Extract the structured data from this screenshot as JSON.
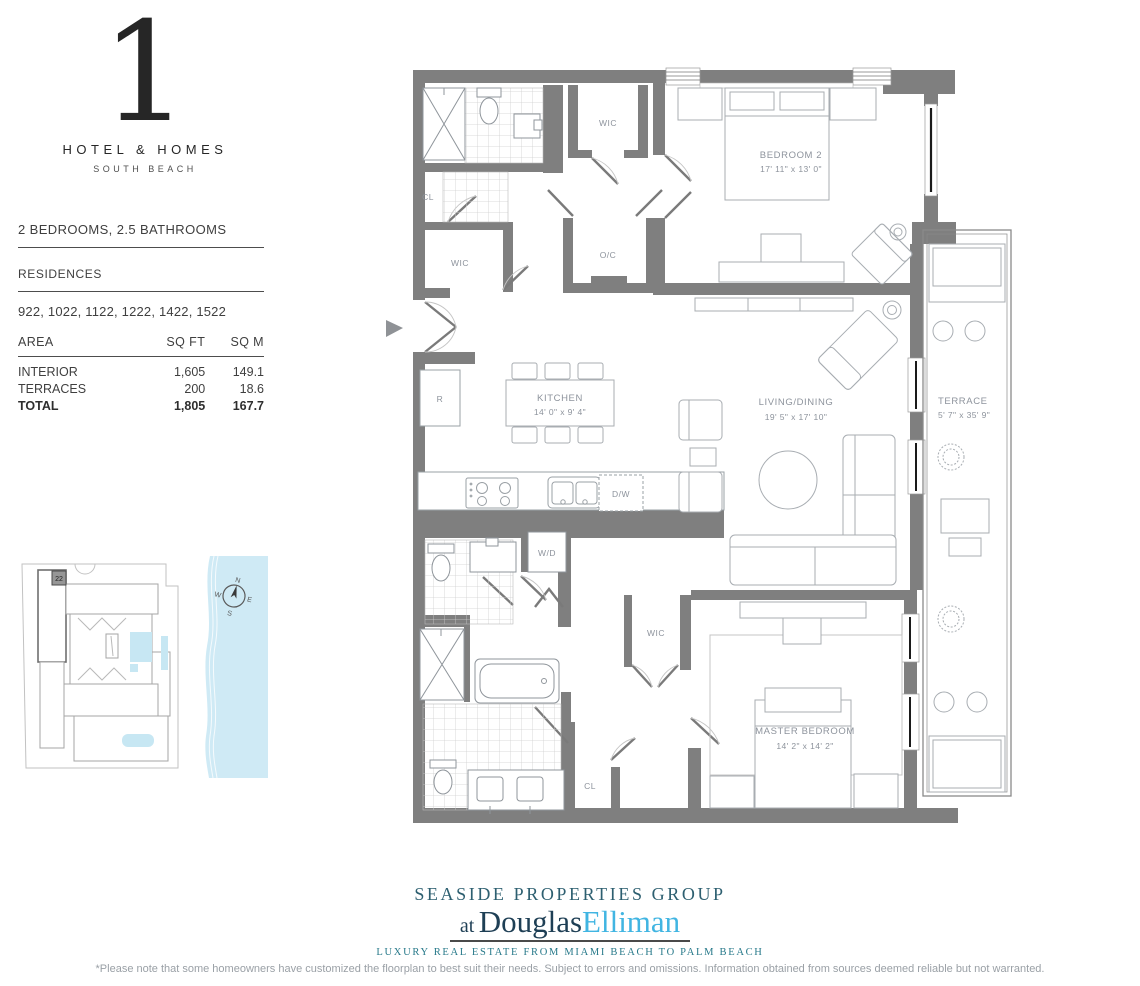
{
  "logo": {
    "numeral": "1",
    "brand": "HOTEL & HOMES",
    "location": "SOUTH BEACH"
  },
  "unit": {
    "headline": "2 BEDROOMS, 2.5 BATHROOMS",
    "residences_label": "RESIDENCES",
    "residences": "922, 1022, 1122, 1222, 1422, 1522"
  },
  "area_table": {
    "headers": {
      "area": "AREA",
      "sqft": "SQ FT",
      "sqm": "SQ M"
    },
    "rows": [
      {
        "label": "INTERIOR",
        "sqft": "1,605",
        "sqm": "149.1"
      },
      {
        "label": "TERRACES",
        "sqft": "200",
        "sqm": "18.6"
      },
      {
        "label": "TOTAL",
        "sqft": "1,805",
        "sqm": "167.7"
      }
    ]
  },
  "floorplan": {
    "rooms": {
      "bedroom2": {
        "name": "BEDROOM 2",
        "dims": "17' 11\" x 13' 0\""
      },
      "kitchen": {
        "name": "KITCHEN",
        "dims": "14' 0\" x 9' 4\""
      },
      "living": {
        "name": "LIVING/DINING",
        "dims": "19' 5\" x 17' 10\""
      },
      "master": {
        "name": "MASTER BEDROOM",
        "dims": "14' 2\" x 14' 2\""
      },
      "terrace": {
        "name": "TERRACE",
        "dims": "5' 7\" x 35' 9\""
      }
    },
    "small_labels": {
      "wic": "WIC",
      "oc": "O/C",
      "cl": "CL",
      "r": "R",
      "dw": "D/W",
      "wd": "W/D"
    }
  },
  "siteplan": {
    "unit_marker": "22",
    "compass": {
      "n": "N",
      "e": "E",
      "s": "S",
      "w": "W"
    }
  },
  "footer": {
    "group": "SEASIDE PROPERTIES GROUP",
    "at": "at",
    "brand_first": "Douglas",
    "brand_second": "Elliman",
    "tagline": "LUXURY REAL ESTATE FROM MIAMI BEACH TO PALM BEACH",
    "disclaimer": "*Please note that some homeowners have customized the floorplan to best suit their needs. Subject to errors and omissions. Information obtained from sources deemed reliable but not warranted."
  },
  "colors": {
    "wall": "#7f7f7f",
    "label": "#8d939c",
    "water": "#cfeaf5",
    "brand_dark": "#1e3f55",
    "brand_teal": "#2d5f70",
    "brand_light": "#41b5e2",
    "tagline": "#27798a"
  }
}
